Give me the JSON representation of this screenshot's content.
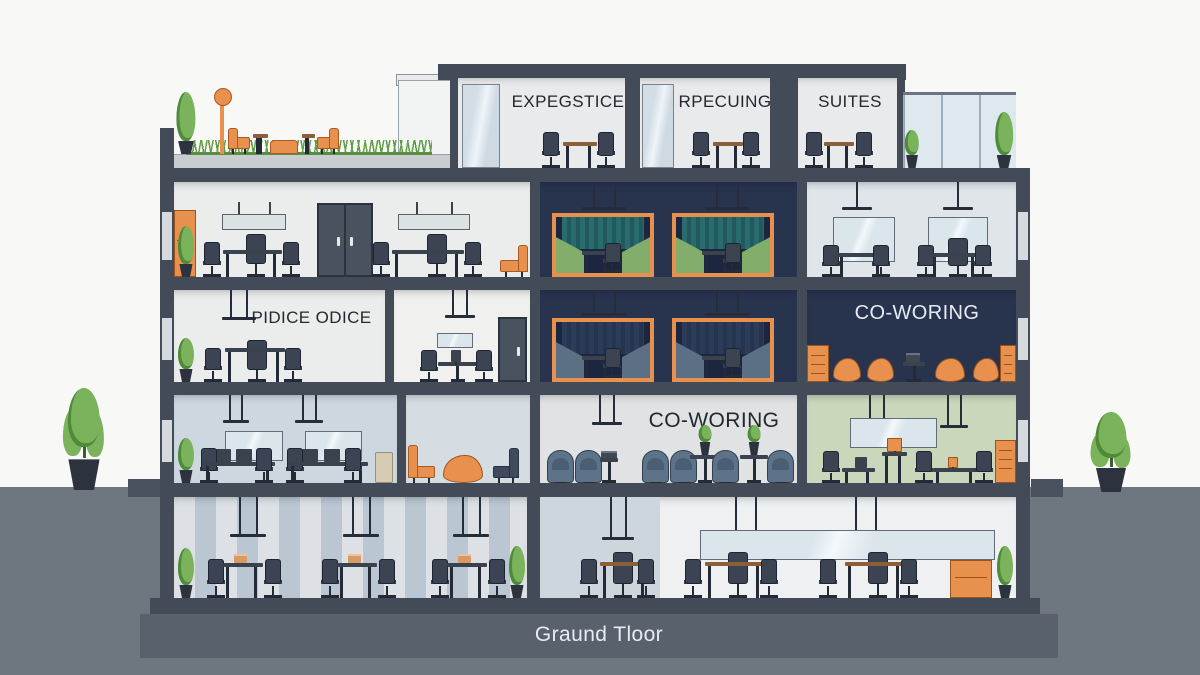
{
  "scene": {
    "type": "office-building-cross-section-illustration",
    "floors": [
      "rooftop-penthouse",
      "level-4",
      "level-3",
      "level-2",
      "ground-level"
    ]
  },
  "labels": {
    "penthouse_room_1": "EXPEGSTICE",
    "penthouse_room_2": "RPECUING",
    "penthouse_room_3": "SUITES",
    "floor3_office": "PIDICE ODICE",
    "floor3_cowork": "CO-WORING",
    "floor2_cowork": "CO-WORING",
    "ground_floor": "Graund Tloor"
  },
  "colors": {
    "background": "#f8f8f7",
    "structure_dark": "#434b59",
    "ground": "#6e7680",
    "foundation_band": "#59616c",
    "room_light": "#ebecec",
    "room_blue_light": "#ccd7e0",
    "room_navy": "#28334e",
    "room_pale_green": "#cbd7ba",
    "accent_orange": "#e8914e",
    "bench_green": "#82ad6b",
    "curtain_teal": "#2a6b6e",
    "chair_dark": "#3c4454",
    "chair_blue": "#5d7389",
    "grass_green": "#67a24b",
    "plant_green": "#7ab35b",
    "glass": "#dce8f0"
  }
}
